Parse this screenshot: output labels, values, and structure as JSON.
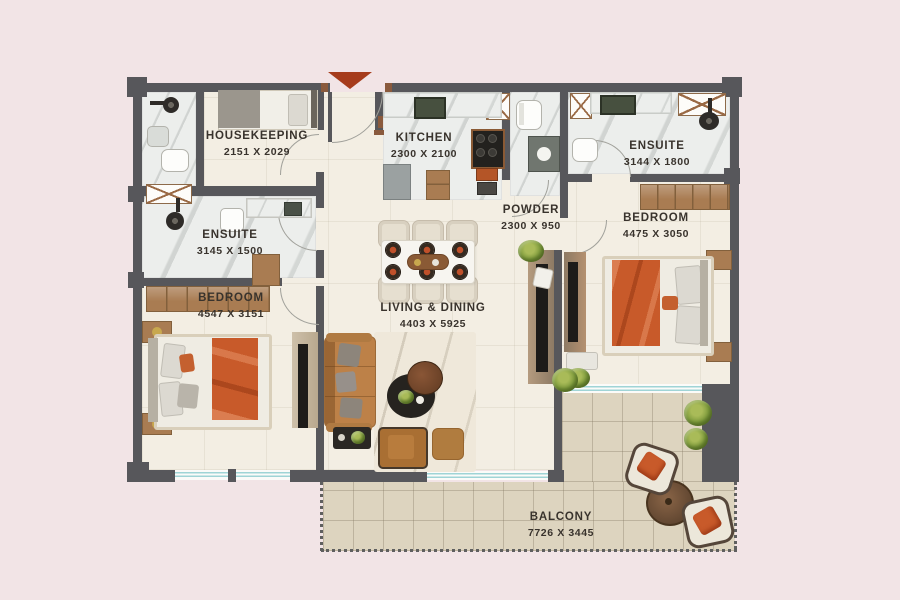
{
  "plan": {
    "title": "Apartment floor plan",
    "rooms": [
      {
        "id": "housekeeping",
        "name": "HOUSEKEEPING",
        "dims": "2151 X 2029"
      },
      {
        "id": "kitchen",
        "name": "KITCHEN",
        "dims": "2300 X 2100"
      },
      {
        "id": "ensuite-right",
        "name": "ENSUITE",
        "dims": "3144 X 1800"
      },
      {
        "id": "powder",
        "name": "POWDER",
        "dims": "2300 X 950"
      },
      {
        "id": "bedroom-right",
        "name": "BEDROOM",
        "dims": "4475 X 3050"
      },
      {
        "id": "ensuite-left",
        "name": "ENSUITE",
        "dims": "3145 X 1500"
      },
      {
        "id": "bedroom-left",
        "name": "BEDROOM",
        "dims": "4547 X 3151"
      },
      {
        "id": "living-dining",
        "name": "LIVING & DINING",
        "dims": "4403 X 5925"
      },
      {
        "id": "balcony",
        "name": "BALCONY",
        "dims": "7726 X 3445"
      }
    ],
    "colors": {
      "background": "#f2e4e6",
      "wall": "#57575b",
      "floor": "#f3eee3",
      "marble": "#eceeec",
      "rug": "#efe8da",
      "balcony_tile": "#ddd4bf",
      "accent_orange": "#c85a2a",
      "entry_marker": "#a63c1c",
      "wood": "#a97c52",
      "wood_dark": "#82603c",
      "sofa": "#bd8148",
      "window_glass": "#9fd4d6",
      "label_text": "#39332d",
      "plant": "#7d9a3c",
      "tv_black": "#1d1b19",
      "frame_beige": "#d9cfba"
    }
  }
}
